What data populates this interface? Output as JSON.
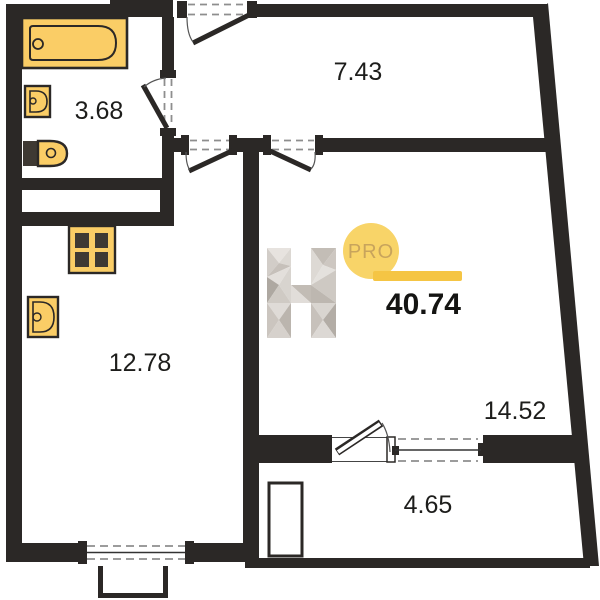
{
  "plan": {
    "total_area": "40.74",
    "logo": {
      "letter": "H",
      "badge": "PRO"
    },
    "rooms": [
      {
        "name": "bathroom",
        "area": "3.68"
      },
      {
        "name": "hallway",
        "area": "7.43"
      },
      {
        "name": "kitchen",
        "area": "12.78"
      },
      {
        "name": "living-room",
        "area": "14.52"
      },
      {
        "name": "balcony",
        "area": "4.65"
      }
    ],
    "fixtures": [
      "bathtub-icon",
      "washbasin-icon",
      "toilet-icon",
      "kitchen-sink-icon",
      "stove-icon"
    ],
    "colors": {
      "wall": "#2B2826",
      "fixture_fill": "#FACD66",
      "fixture_dark": "#3E3933",
      "opening_dash": "#8E8E8E",
      "accent_bar": "#F5C544",
      "badge_circle": "#F8D468",
      "badge_text": "#C8A45C",
      "logo_gray": "#D7D2CD",
      "label_text": "#1d1d1b"
    }
  }
}
